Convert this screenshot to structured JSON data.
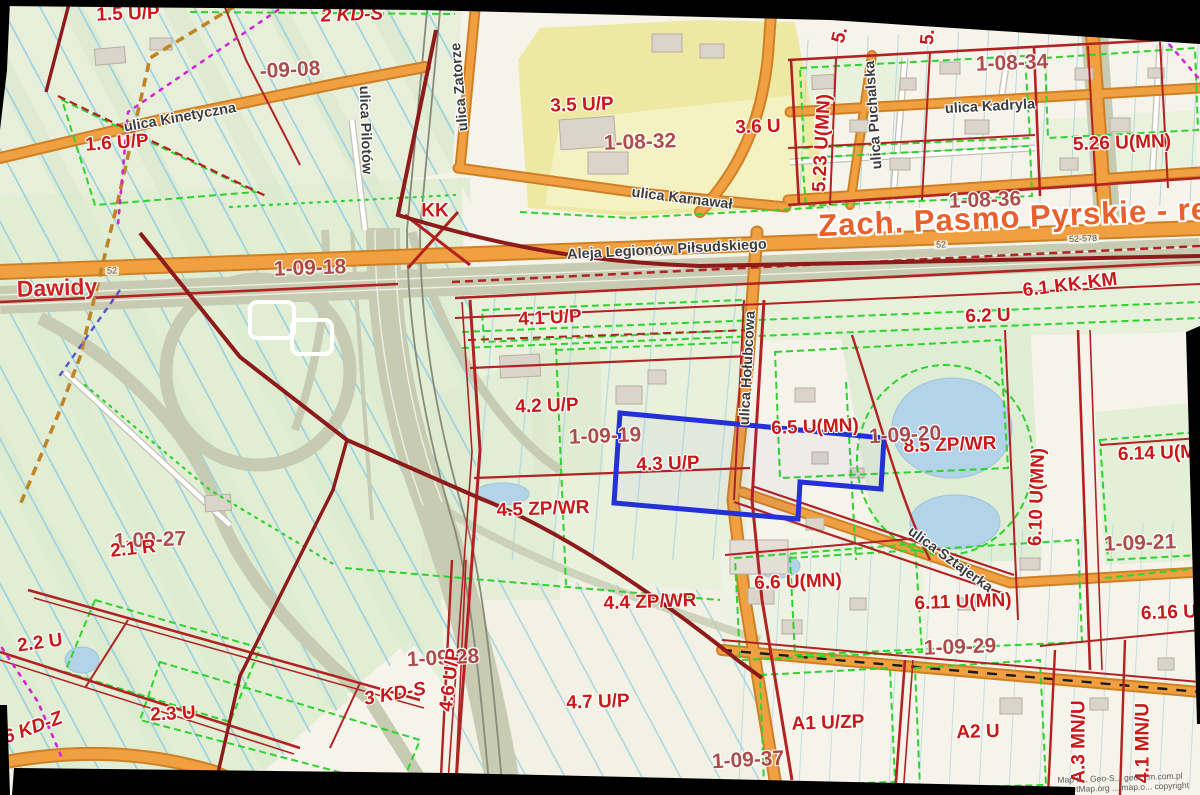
{
  "map": {
    "title": "Zach. Pasmo Pyrskie - rej. u",
    "place_name": "Dawidy",
    "attribution_line1": "Map ti... Geo-S...  geo-...m.com.pl",
    "attribution_line2": "OpenStreetMap.org ...tmap.o... copyright",
    "highlight_color": "#2431d6",
    "colors": {
      "background": "#f6f3ea",
      "field_green": "#e3eed6",
      "zone_yellow": "#f1eda6",
      "road_orange": "#f0a041",
      "motorway_grey": "#c6cbb1",
      "boundary_red": "#b22222",
      "boundary_maroon": "#8e1a1a",
      "green_dashed": "#2ed32e",
      "magenta_dashed": "#d028d0",
      "tan_dashed": "#c08428",
      "ditch_cyan": "#93cfe3",
      "water_blue": "#b3d3e8",
      "zone_label_red": "#c81818",
      "district_label": "#a8403f",
      "title_orange": "#e8602c"
    },
    "labels": [
      {
        "t": "1.5 U/P",
        "x": 128,
        "y": 14,
        "r": -2,
        "c": "z"
      },
      {
        "t": "2 KD-S",
        "x": 352,
        "y": 15,
        "r": -2,
        "c": "k"
      },
      {
        "t": "-09-08",
        "x": 290,
        "y": 70,
        "r": -3,
        "c": "d"
      },
      {
        "t": "1.6 U/P",
        "x": 117,
        "y": 143,
        "r": -4,
        "c": "z"
      },
      {
        "t": "3.5 U/P",
        "x": 582,
        "y": 105,
        "r": -2,
        "c": "z"
      },
      {
        "t": "1-08-32",
        "x": 640,
        "y": 142,
        "r": -2,
        "c": "d"
      },
      {
        "t": "3.6 U",
        "x": 758,
        "y": 127,
        "r": -2,
        "c": "z"
      },
      {
        "t": "KK",
        "x": 435,
        "y": 211,
        "r": 0,
        "c": "z"
      },
      {
        "t": "5.",
        "x": 840,
        "y": 35,
        "r": -75,
        "c": "z"
      },
      {
        "t": "5.",
        "x": 928,
        "y": 37,
        "r": -85,
        "c": "z"
      },
      {
        "t": "5.23 U(MN)",
        "x": 822,
        "y": 143,
        "r": -87,
        "c": "z"
      },
      {
        "t": "1-08-34",
        "x": 1012,
        "y": 63,
        "r": -2,
        "c": "d"
      },
      {
        "t": "5.26 U(MN)",
        "x": 1122,
        "y": 143,
        "r": -2,
        "c": "z"
      },
      {
        "t": "1-08-36",
        "x": 985,
        "y": 200,
        "r": -2,
        "c": "d"
      },
      {
        "t": "1-09-18",
        "x": 310,
        "y": 268,
        "r": -2,
        "c": "d"
      },
      {
        "t": "6.1 KK-KM",
        "x": 1070,
        "y": 285,
        "r": -7,
        "c": "z"
      },
      {
        "t": "6.2 U",
        "x": 988,
        "y": 316,
        "r": -2,
        "c": "z"
      },
      {
        "t": "4.1 U/P",
        "x": 550,
        "y": 318,
        "r": -3,
        "c": "z"
      },
      {
        "t": "4.2 U/P",
        "x": 547,
        "y": 406,
        "r": -2,
        "c": "z"
      },
      {
        "t": "1-09-19",
        "x": 605,
        "y": 436,
        "r": -2,
        "c": "d"
      },
      {
        "t": "4.3 U/P",
        "x": 668,
        "y": 464,
        "r": -2,
        "c": "z"
      },
      {
        "t": "6.5 U(MN)",
        "x": 815,
        "y": 427,
        "r": -2,
        "c": "z"
      },
      {
        "t": "8.5 ZP/WR",
        "x": 950,
        "y": 445,
        "r": -2,
        "c": "z"
      },
      {
        "t": "1-09-20",
        "x": 905,
        "y": 435,
        "r": -3,
        "c": "d"
      },
      {
        "t": "6.14 U(MN)",
        "x": 1167,
        "y": 453,
        "r": -2,
        "c": "z"
      },
      {
        "t": "6.10 U(MN)",
        "x": 1037,
        "y": 497,
        "r": -88,
        "c": "z"
      },
      {
        "t": "1-09-21",
        "x": 1140,
        "y": 543,
        "r": -2,
        "c": "d"
      },
      {
        "t": "4.5 ZP/WR",
        "x": 543,
        "y": 509,
        "r": -2,
        "c": "z"
      },
      {
        "t": "1-09-27",
        "x": 150,
        "y": 540,
        "r": -2,
        "c": "d"
      },
      {
        "t": "2.1 R",
        "x": 133,
        "y": 549,
        "r": -6,
        "c": "z"
      },
      {
        "t": "6.6 U(MN)",
        "x": 798,
        "y": 582,
        "r": -2,
        "c": "z"
      },
      {
        "t": "6.11 U(MN)",
        "x": 963,
        "y": 602,
        "r": -2,
        "c": "z"
      },
      {
        "t": "1-09-29",
        "x": 960,
        "y": 647,
        "r": -2,
        "c": "d"
      },
      {
        "t": "2.2 U",
        "x": 40,
        "y": 643,
        "r": -8,
        "c": "z"
      },
      {
        "t": "6.16 U(MN)",
        "x": 1190,
        "y": 612,
        "r": -2,
        "c": "z"
      },
      {
        "t": "2.3 U",
        "x": 173,
        "y": 714,
        "r": -3,
        "c": "z"
      },
      {
        "t": "6 KD-Z",
        "x": 33,
        "y": 728,
        "r": -20,
        "c": "k"
      },
      {
        "t": "3 KD-S",
        "x": 395,
        "y": 694,
        "r": -10,
        "c": "k"
      },
      {
        "t": "1-09-28",
        "x": 443,
        "y": 658,
        "r": -3,
        "c": "d"
      },
      {
        "t": "4.6 U/P",
        "x": 450,
        "y": 680,
        "r": -83,
        "c": "z"
      },
      {
        "t": "4.4 ZP/WR",
        "x": 650,
        "y": 602,
        "r": -2,
        "c": "z"
      },
      {
        "t": "4.7 U/P",
        "x": 598,
        "y": 702,
        "r": -2,
        "c": "z"
      },
      {
        "t": "1-09-37",
        "x": 748,
        "y": 760,
        "r": -3,
        "c": "d"
      },
      {
        "t": "A1 U/ZP",
        "x": 828,
        "y": 723,
        "r": -2,
        "c": "z"
      },
      {
        "t": "A2 U",
        "x": 978,
        "y": 732,
        "r": -2,
        "c": "z"
      },
      {
        "t": "A.3 MN/U",
        "x": 1079,
        "y": 742,
        "r": -90,
        "c": "z"
      },
      {
        "t": "4.1 MN/U",
        "x": 1143,
        "y": 743,
        "r": -90,
        "c": "z"
      },
      {
        "t": "ulica Kinetyczna",
        "x": 180,
        "y": 118,
        "r": -10,
        "c": "s"
      },
      {
        "t": "ulica Pilotów",
        "x": 365,
        "y": 130,
        "r": 88,
        "c": "s"
      },
      {
        "t": "ulica Zatorze",
        "x": 460,
        "y": 87,
        "r": -95,
        "c": "s"
      },
      {
        "t": "ulica Karnawał",
        "x": 682,
        "y": 199,
        "r": 7,
        "c": "s"
      },
      {
        "t": "Aleja Legionów Piłsudskiego",
        "x": 667,
        "y": 250,
        "r": -3,
        "c": "s"
      },
      {
        "t": "ulica Puchalska",
        "x": 874,
        "y": 115,
        "r": -94,
        "c": "s"
      },
      {
        "t": "ulica Kadryla",
        "x": 990,
        "y": 107,
        "r": -3,
        "c": "s"
      },
      {
        "t": "ulica Hołubcowa",
        "x": 748,
        "y": 368,
        "r": -87,
        "c": "s"
      },
      {
        "t": "ulica Sztajerka",
        "x": 950,
        "y": 560,
        "r": 36,
        "c": "s"
      },
      {
        "t": "Dawidy",
        "x": 57,
        "y": 288,
        "r": -2,
        "c": "p"
      },
      {
        "t": "Zach. Pasmo Pyrskie - rej. u",
        "x": 1038,
        "y": 216,
        "r": -2.5,
        "c": "t"
      },
      {
        "t": "52",
        "x": 112,
        "y": 271,
        "r": -2,
        "c": "n"
      },
      {
        "t": "52",
        "x": 941,
        "y": 245,
        "r": -2,
        "c": "n"
      },
      {
        "t": "52-578",
        "x": 1083,
        "y": 239,
        "r": -2,
        "c": "n"
      },
      {
        "t": "Map ti... Geo-S...  geo-...m.com.pl",
        "x": 1120,
        "y": 778,
        "r": -2,
        "c": "a"
      },
      {
        "t": "OpenStreetMap.org ...tmap.o... copyright",
        "x": 1112,
        "y": 788,
        "r": -2,
        "c": "a"
      }
    ]
  }
}
